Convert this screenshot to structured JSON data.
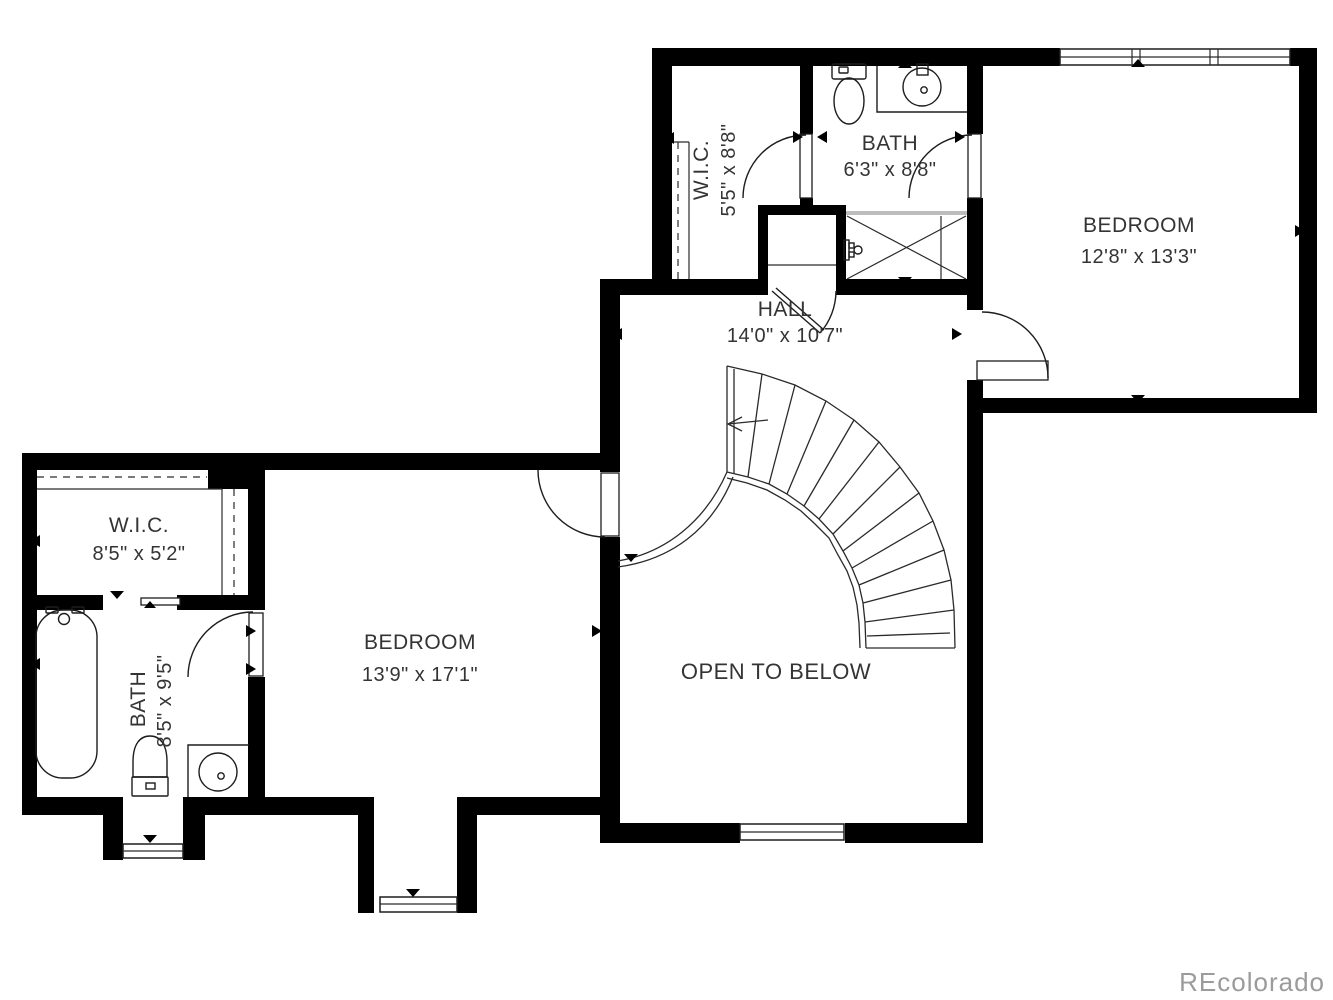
{
  "plan_title": "Second floor plan",
  "watermark": "REcolorado",
  "colors": {
    "wall": "#000000",
    "line": "#1d1d1d",
    "label_text": "#343434",
    "watermark_text": "#9b9b9b",
    "shower_glass": "#bdbdbd",
    "background": "#ffffff"
  },
  "rooms": {
    "wic_upper": {
      "name": "W.I.C.",
      "dims": "5'5\" x 8'8\""
    },
    "bath_upper": {
      "name": "BATH",
      "dims": "6'3\" x 8'8\""
    },
    "bedroom_right": {
      "name": "BEDROOM",
      "dims": "12'8\" x 13'3\""
    },
    "hall": {
      "name": "HALL",
      "dims": "14'0\" x 10'7\""
    },
    "wic_left": {
      "name": "W.I.C.",
      "dims": "8'5\" x 5'2\""
    },
    "bath_left": {
      "name": "BATH",
      "dims": "8'5\" x 9'5\""
    },
    "bedroom_left": {
      "name": "BEDROOM",
      "dims": "13'9\" x 17'1\""
    },
    "open_below": {
      "name": "OPEN TO BELOW"
    }
  }
}
